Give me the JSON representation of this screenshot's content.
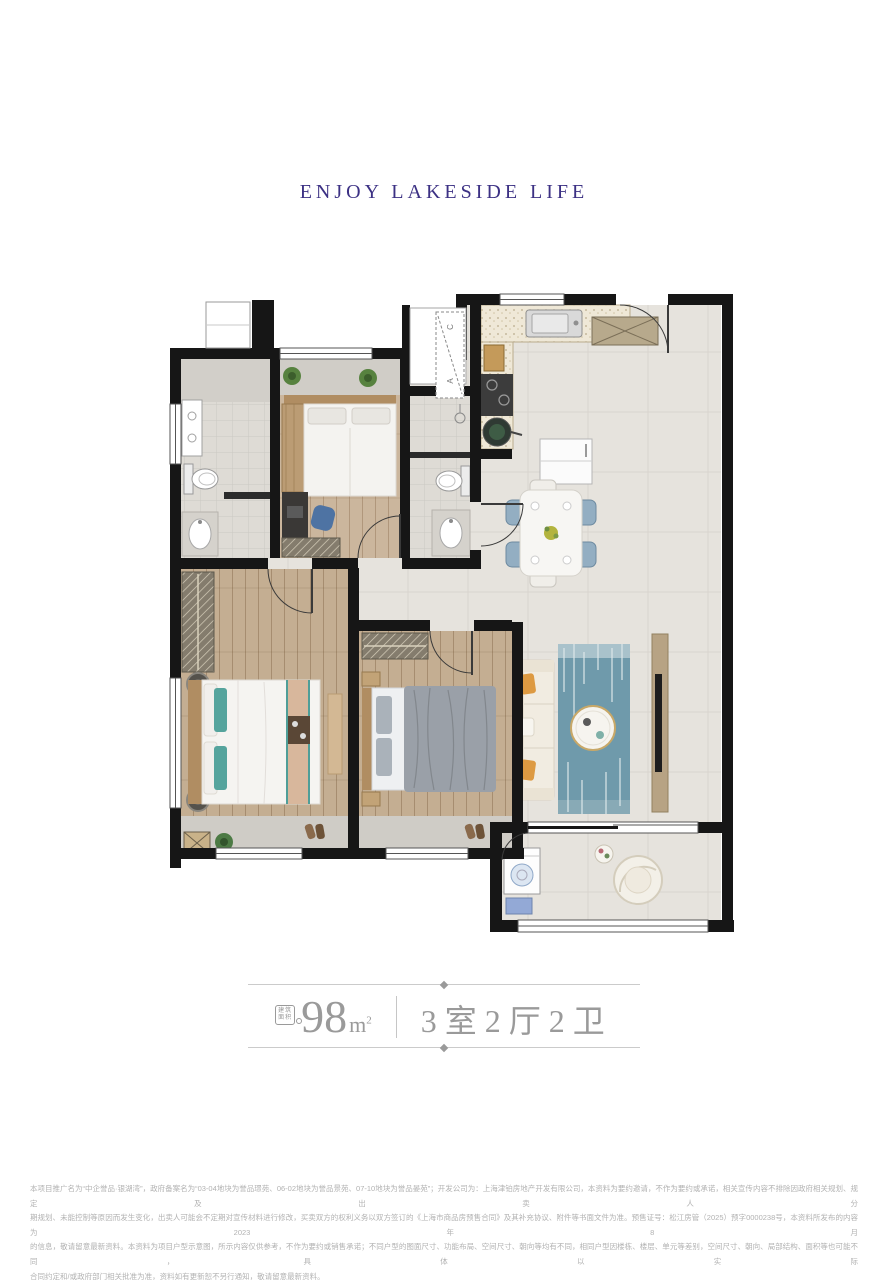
{
  "header": {
    "title": "ENJOY LAKESIDE LIFE",
    "color": "#3c3184"
  },
  "floorplan": {
    "shaft_label_c": "C",
    "shaft_label_a": "A",
    "wall_color": "#161616",
    "tile_color": "#e6e3dd",
    "wood_color": "#c9b59c",
    "accent_rug_color": "#6f9aab"
  },
  "area_info": {
    "badge_line1": "建筑",
    "badge_line2": "面积",
    "area_value": "98",
    "unit_m": "m",
    "unit_sup": "2",
    "layout": "3室2厅2卫",
    "text_color": "#9a9a9a"
  },
  "disclaimer": {
    "lines": [
      "本项目推广名为“中企誉品·银湖湾”，政府备案名为“03-04地块为誉品璟苑、06-02地块为誉品景苑、07-10地块为誉品晏苑”；开发公司为：上海津铂房地产开发有限公司，本资料为要约邀请，不作为要约或承诺，相关宣传内容不排除因政府相关规划、规定及出卖人分",
      "期规划、未能控制等原因而发生变化，出卖人可能会不定期对宣传材料进行修改，买卖双方的权利义务以双方签订的《上海市商品房预售合同》及其补充协议、附件等书面文件为准。预售证号：松江房管（2025）预字0000238号，本资料所发布的内容为2023年8月",
      "的信息，敬请留意最新资料。本资料为项目户型示意图，所示内容仅供参考，不作为要约或销售承诺；不同户型的图面尺寸、功能布局、空间尺寸、朝向等均有不同，相同户型因楼栋、楼层、单元等差别，空间尺寸、朝向、局部结构、面积等也可能不同，具体以实际",
      "合同约定和/或政府部门相关批准为准，资料如有更新恕不另行通知，敬请留意最新资料。"
    ]
  }
}
